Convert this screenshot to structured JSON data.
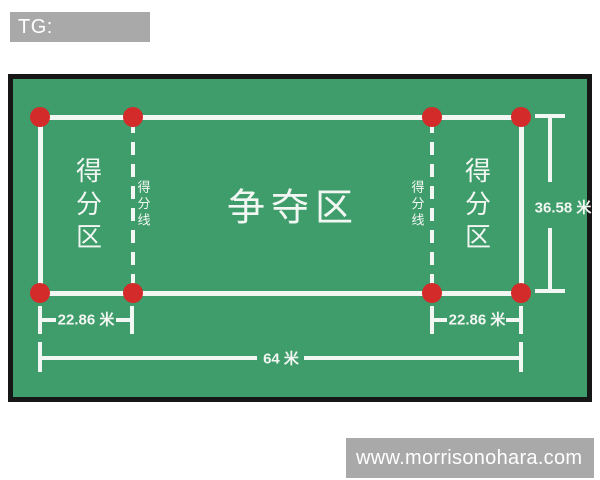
{
  "tag": {
    "label": "TG: MYYJJPP"
  },
  "watermark": {
    "text": "www.morrisonohara.com"
  },
  "court": {
    "zone_left": "得分区",
    "zone_center": "争夺区",
    "zone_right": "得分区",
    "scoring_line_left": "得分线",
    "scoring_line_right": "得分线",
    "dim_height": "36.58 米",
    "dim_left_width": "22.86 米",
    "dim_right_width": "22.86 米",
    "dim_total_width": "64 米"
  },
  "colors": {
    "field_green": "#3e9d6a",
    "court_line_white": "#f3f7f3",
    "marker_red": "#d32a2a",
    "border_black": "#161616",
    "overlay_gray": "#a9a9a9"
  }
}
